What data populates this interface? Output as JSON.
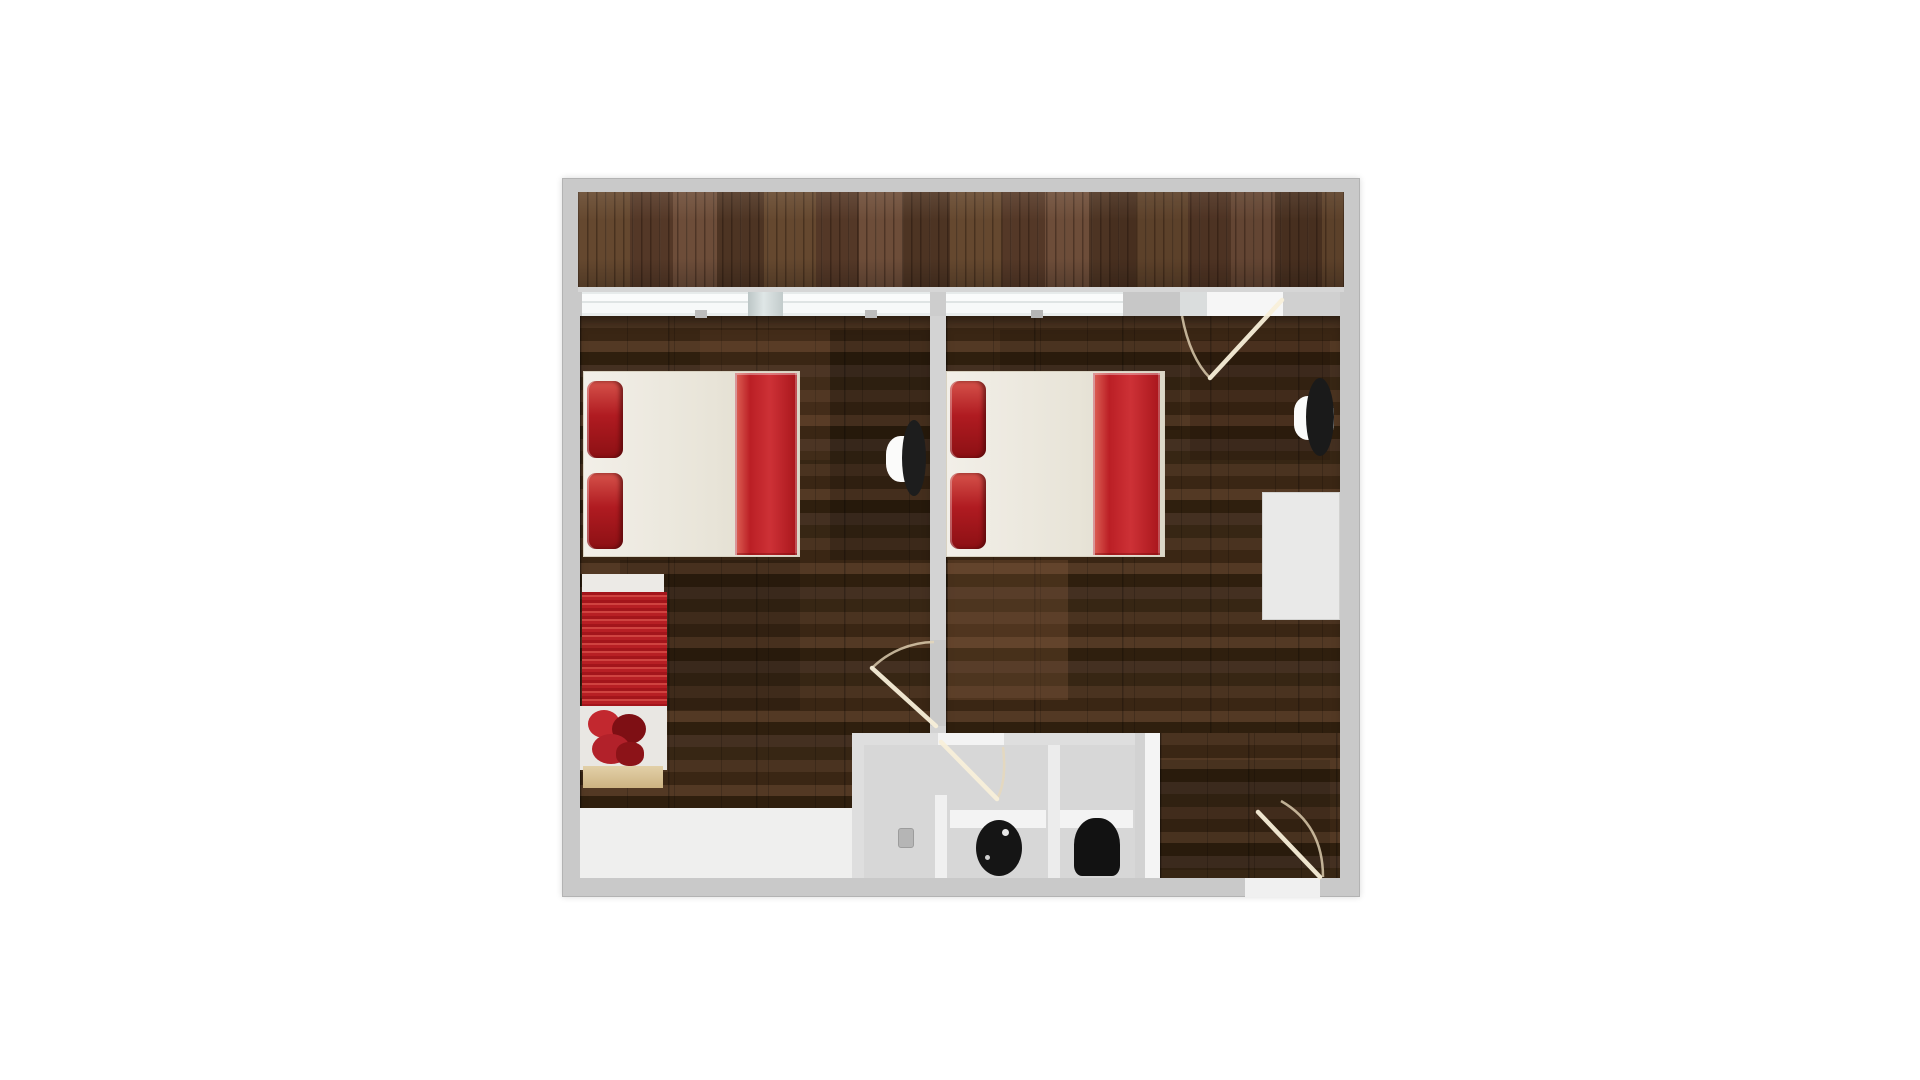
{
  "title": "floor-plan-render",
  "canvas": {
    "width": 1920,
    "height": 1080,
    "background": "#ffffff"
  },
  "palette": {
    "outer_wall": "#c9c9c9",
    "deck_wood": "#5c4130",
    "floor_wood": "#3c2817",
    "accent_red": "#bf2329",
    "mattress_white": "#ece8df",
    "bathroom_floor": "#d7d7d7",
    "fixture_black": "#151515",
    "base_tan": "#d8c197",
    "door_leaf_line": "#f8efd9",
    "door_arc_line": "#e8d9ba"
  },
  "scene": {
    "items": [
      {
        "name": "outer-wall-slab",
        "cls": "wall-slab",
        "x": 562,
        "y": 178,
        "w": 798,
        "h": 719,
        "fill": "#c9c9c9",
        "z": 1
      },
      {
        "name": "deck-floor",
        "cls": "deck-wood",
        "x": 578,
        "y": 192,
        "w": 766,
        "h": 95,
        "z": 2
      },
      {
        "name": "deck-shade-patch",
        "x": 1110,
        "y": 192,
        "w": 234,
        "h": 95,
        "fill": "rgba(35,18,8,0.12)",
        "z": 2
      },
      {
        "name": "window-sill",
        "x": 578,
        "y": 287,
        "w": 766,
        "h": 5,
        "fill": "#d6d6d6",
        "z": 3
      },
      {
        "name": "window-glass-1",
        "cls": "glass",
        "x": 582,
        "y": 292,
        "w": 166,
        "h": 24,
        "z": 3
      },
      {
        "name": "window-mullion",
        "cls": "glassdark",
        "x": 748,
        "y": 292,
        "w": 35,
        "h": 24,
        "z": 3
      },
      {
        "name": "window-glass-2",
        "cls": "glass",
        "x": 783,
        "y": 292,
        "w": 147,
        "h": 24,
        "z": 3
      },
      {
        "name": "wall-junction",
        "x": 930,
        "y": 292,
        "w": 16,
        "h": 24,
        "fill": "#cdcdcd",
        "z": 3
      },
      {
        "name": "window-glass-3",
        "cls": "glass",
        "x": 946,
        "y": 292,
        "w": 177,
        "h": 24,
        "z": 3
      },
      {
        "name": "wall-segment-a",
        "x": 1123,
        "y": 292,
        "w": 57,
        "h": 24,
        "fill": "#c7c7c7",
        "z": 3
      },
      {
        "name": "deck-door-frame",
        "x": 1180,
        "y": 292,
        "w": 27,
        "h": 24,
        "fill": "#dadddd",
        "z": 3
      },
      {
        "name": "deck-doorway",
        "x": 1207,
        "y": 292,
        "w": 76,
        "h": 24,
        "fill": "#f6f6f6",
        "z": 3
      },
      {
        "name": "wall-segment-b",
        "x": 1283,
        "y": 292,
        "w": 57,
        "h": 24,
        "fill": "#d0d0d0",
        "z": 3
      },
      {
        "name": "bedroom-left-floor",
        "cls": "room-wood",
        "x": 580,
        "y": 316,
        "w": 350,
        "h": 492,
        "z": 2
      },
      {
        "name": "bedroom-right-floor",
        "cls": "room-wood",
        "x": 946,
        "y": 316,
        "w": 394,
        "h": 417,
        "z": 2
      },
      {
        "name": "bedroom-right-floor-lower",
        "cls": "room-wood noshadow",
        "x": 1160,
        "y": 733,
        "w": 180,
        "h": 145,
        "z": 2
      },
      {
        "name": "floor-patch-1",
        "x": 700,
        "y": 330,
        "w": 130,
        "h": 130,
        "fill": "rgba(125,85,55,0.14)",
        "z": 2
      },
      {
        "name": "floor-patch-2",
        "x": 830,
        "y": 330,
        "w": 100,
        "h": 230,
        "fill": "rgba(0,0,0,0.18)",
        "z": 2
      },
      {
        "name": "floor-patch-3",
        "x": 620,
        "y": 560,
        "w": 180,
        "h": 150,
        "fill": "rgba(0,0,0,0.14)",
        "z": 2
      },
      {
        "name": "floor-patch-4",
        "x": 948,
        "y": 560,
        "w": 120,
        "h": 140,
        "fill": "rgba(160,110,72,0.22)",
        "z": 2
      },
      {
        "name": "floor-patch-5",
        "x": 1190,
        "y": 340,
        "w": 140,
        "h": 120,
        "fill": "rgba(25,12,6,0.18)",
        "z": 2
      },
      {
        "name": "floor-patch-6",
        "x": 1160,
        "y": 760,
        "w": 170,
        "h": 110,
        "fill": "rgba(0,0,0,0.12)",
        "z": 2
      },
      {
        "name": "floor-patch-7",
        "x": 1000,
        "y": 330,
        "w": 180,
        "h": 100,
        "fill": "rgba(0,0,0,0.10)",
        "z": 2
      },
      {
        "name": "left-floor-white-strip",
        "x": 580,
        "y": 808,
        "w": 272,
        "h": 70,
        "fill": "#efefee",
        "z": 2
      },
      {
        "name": "bathroom-floor",
        "x": 852,
        "y": 733,
        "w": 293,
        "h": 145,
        "fill": "#d7d7d7",
        "z": 2
      },
      {
        "name": "divider-wall",
        "x": 930,
        "y": 316,
        "w": 16,
        "h": 324,
        "fill": "#d3d3d3",
        "z": 3
      },
      {
        "name": "divider-wall-stub",
        "x": 930,
        "y": 726,
        "w": 16,
        "h": 7,
        "fill": "#d3d3d3",
        "z": 3
      },
      {
        "name": "bathroom-top-wall-left",
        "x": 852,
        "y": 733,
        "w": 86,
        "h": 12,
        "fill": "#dedede",
        "z": 3
      },
      {
        "name": "bathroom-doorway",
        "x": 938,
        "y": 733,
        "w": 66,
        "h": 12,
        "fill": "#f3f3f3",
        "z": 3
      },
      {
        "name": "bathroom-top-wall-right",
        "x": 1004,
        "y": 733,
        "w": 131,
        "h": 12,
        "fill": "#dedede",
        "z": 3
      },
      {
        "name": "bathroom-left-wall",
        "x": 852,
        "y": 733,
        "w": 12,
        "h": 145,
        "fill": "#dedede",
        "z": 3
      },
      {
        "name": "bathroom-right-wall",
        "x": 1135,
        "y": 733,
        "w": 10,
        "h": 145,
        "fill": "#d2d2d2",
        "z": 3
      },
      {
        "name": "bathroom-right-lining",
        "x": 1145,
        "y": 733,
        "w": 15,
        "h": 145,
        "fill": "#f4f4f4",
        "z": 3
      },
      {
        "name": "wc-divider-wall",
        "x": 1048,
        "y": 745,
        "w": 12,
        "h": 133,
        "fill": "#ececec",
        "z": 3
      },
      {
        "name": "shower-stub-wall",
        "x": 935,
        "y": 795,
        "w": 12,
        "h": 83,
        "fill": "#f0f0f0",
        "z": 3
      },
      {
        "name": "entry-threshold",
        "x": 1245,
        "y": 878,
        "w": 75,
        "h": 19,
        "fill": "#f0f0f0",
        "z": 3
      },
      {
        "name": "window-frame-tick-1",
        "x": 695,
        "y": 310,
        "w": 12,
        "h": 8,
        "fill": "#bdbdbd",
        "z": 3
      },
      {
        "name": "window-frame-tick-2",
        "x": 865,
        "y": 310,
        "w": 12,
        "h": 8,
        "fill": "#bdbdbd",
        "z": 3
      },
      {
        "name": "window-frame-tick-3",
        "x": 1031,
        "y": 310,
        "w": 12,
        "h": 8,
        "fill": "#b5b5b5",
        "z": 3
      },
      {
        "name": "bed-left-mattress",
        "cls": "mattress",
        "x": 583,
        "y": 371,
        "w": 217,
        "h": 186,
        "z": 4
      },
      {
        "name": "bed-left-blanket",
        "cls": "blanket",
        "x": 735,
        "y": 373,
        "w": 62,
        "h": 182,
        "z": 4
      },
      {
        "name": "bed-left-pillow-top",
        "cls": "pillow",
        "x": 587,
        "y": 381,
        "w": 36,
        "h": 77,
        "z": 4
      },
      {
        "name": "bed-left-pillow-bottom",
        "cls": "pillow",
        "x": 587,
        "y": 473,
        "w": 36,
        "h": 76,
        "z": 4
      },
      {
        "name": "bed-right-mattress",
        "cls": "mattress",
        "x": 946,
        "y": 371,
        "w": 219,
        "h": 186,
        "z": 4
      },
      {
        "name": "bed-right-blanket",
        "cls": "blanket",
        "x": 1093,
        "y": 373,
        "w": 67,
        "h": 182,
        "z": 4
      },
      {
        "name": "bed-right-pillow-top",
        "cls": "pillow",
        "x": 950,
        "y": 381,
        "w": 36,
        "h": 77,
        "z": 4
      },
      {
        "name": "bed-right-pillow-bottom",
        "cls": "pillow",
        "x": 950,
        "y": 473,
        "w": 36,
        "h": 76,
        "z": 4
      },
      {
        "name": "daybed-frame-top",
        "x": 582,
        "y": 574,
        "w": 82,
        "h": 20,
        "fill": "#eceae6",
        "z": 4
      },
      {
        "name": "daybed-ribbed-cushion",
        "cls": "ribbed",
        "x": 582,
        "y": 592,
        "w": 85,
        "h": 116,
        "z": 4
      },
      {
        "name": "daybed-seat-frame",
        "x": 580,
        "y": 706,
        "w": 87,
        "h": 64,
        "fill": "#e9e7e3",
        "z": 4
      },
      {
        "name": "daybed-blanket-pile-1",
        "x": 588,
        "y": 710,
        "w": 32,
        "h": 28,
        "fill": "#c2282f",
        "radius": "50%",
        "z": 4
      },
      {
        "name": "daybed-blanket-pile-2",
        "x": 612,
        "y": 714,
        "w": 34,
        "h": 30,
        "fill": "#7e0f14",
        "radius": "50%",
        "z": 4
      },
      {
        "name": "daybed-blanket-pile-3",
        "x": 592,
        "y": 734,
        "w": 38,
        "h": 30,
        "fill": "#b2212a",
        "radius": "50%",
        "z": 4
      },
      {
        "name": "daybed-blanket-pile-4",
        "x": 616,
        "y": 742,
        "w": 28,
        "h": 24,
        "fill": "#8c1318",
        "radius": "45%",
        "z": 4
      },
      {
        "name": "daybed-base",
        "cls": "mat-tan",
        "x": 583,
        "y": 766,
        "w": 80,
        "h": 22,
        "z": 4
      },
      {
        "name": "wall-lamp-left-glow",
        "x": 886,
        "y": 436,
        "w": 36,
        "h": 46,
        "fill": "#fbfbfa",
        "radius": "40%",
        "z": 4
      },
      {
        "name": "wall-lamp-left",
        "x": 902,
        "y": 420,
        "w": 24,
        "h": 76,
        "fill": "#1d1d1d",
        "radius": "50%",
        "z": 4
      },
      {
        "name": "wall-lamp-right-glow",
        "x": 1294,
        "y": 396,
        "w": 40,
        "h": 44,
        "fill": "#fbfbfa",
        "radius": "35%",
        "z": 4
      },
      {
        "name": "wall-lamp-right",
        "x": 1306,
        "y": 378,
        "w": 28,
        "h": 78,
        "fill": "#1a1a1a",
        "radius": "50%",
        "z": 4
      },
      {
        "name": "desk",
        "x": 1262,
        "y": 492,
        "w": 78,
        "h": 128,
        "fill": "#e9e9e8",
        "border": "1px solid #d2d2d0",
        "z": 4
      },
      {
        "name": "toilet-left-tank",
        "x": 950,
        "y": 810,
        "w": 96,
        "h": 18,
        "fill": "#f3f3f3",
        "z": 4
      },
      {
        "name": "toilet-right-tank",
        "x": 1060,
        "y": 810,
        "w": 73,
        "h": 18,
        "fill": "#f3f3f3",
        "z": 4
      },
      {
        "name": "toilet-left",
        "x": 976,
        "y": 820,
        "w": 46,
        "h": 56,
        "fill": "#151515",
        "radius": "50%",
        "z": 5
      },
      {
        "name": "toilet-left-highlight",
        "x": 1002,
        "y": 829,
        "w": 7,
        "h": 7,
        "fill": "#e8e8e8",
        "radius": "50%",
        "z": 5
      },
      {
        "name": "toilet-left-dot",
        "x": 985,
        "y": 855,
        "w": 5,
        "h": 5,
        "fill": "#cfcfcf",
        "radius": "50%",
        "z": 5
      },
      {
        "name": "toilet-right",
        "x": 1074,
        "y": 818,
        "w": 46,
        "h": 58,
        "fill": "#121212",
        "radius": "46% 46% 18% 18%",
        "z": 5
      },
      {
        "name": "shower-drain",
        "x": 898,
        "y": 828,
        "w": 16,
        "h": 20,
        "fill": "#b5b5b5",
        "radius": "3px",
        "border": "1px solid #9c9c9c",
        "z": 5
      }
    ],
    "doors": [
      {
        "name": "deck-door",
        "leaf": "M1282 300 L1210 378",
        "arc": "M1182 316 Q1190 358 1210 378"
      },
      {
        "name": "bedroom-divider-door",
        "leaf": "M936 726 L872 668",
        "arc": "M934 642 A 90 90 0 0 0 872 668"
      },
      {
        "name": "wc-door",
        "leaf": "M941 742 L997 799",
        "arc": "M1003 747 Q1007 781 997 799"
      },
      {
        "name": "entry-door",
        "leaf": "M1258 812 L1320 877",
        "arc": "M1281 801 Q1323 825 1323 877"
      }
    ]
  }
}
